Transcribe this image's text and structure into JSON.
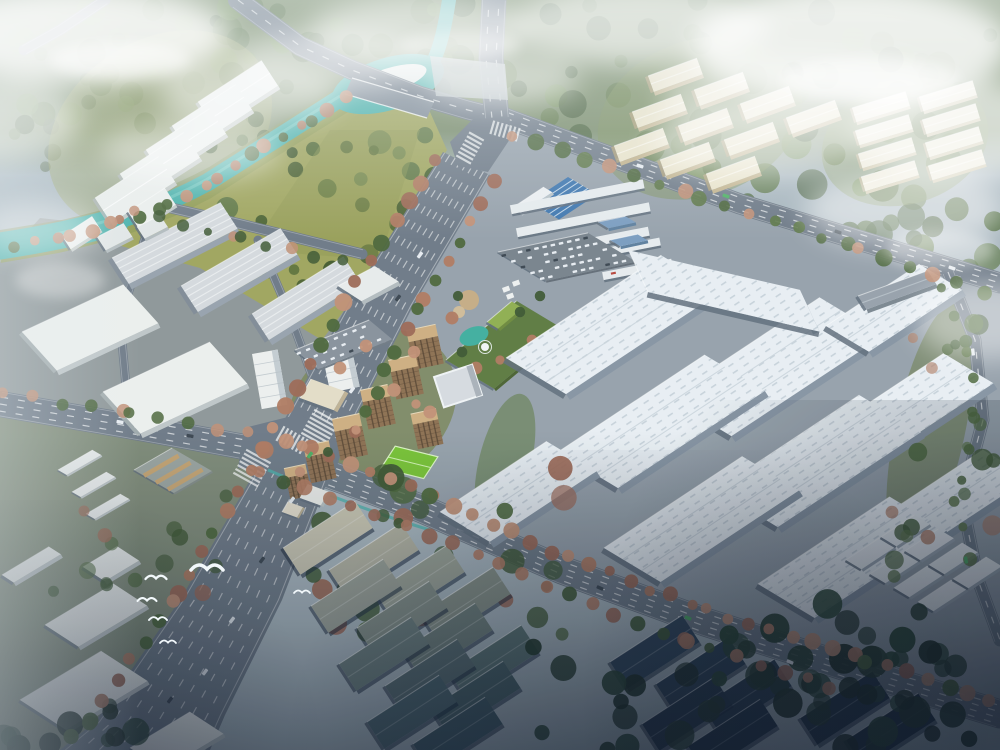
{
  "scene": {
    "description": "Aerial bird's-eye architectural rendering of a planned industrial park campus: large white factory halls in a rotated grid, an entrance gate with blue roof, staff parking, landscaped garden with pond, residential mid-rise towers with a bright green sports field, a public park with a teal canal and bridge, rows of white and cream warehouses, tree-lined avenues, flying gulls, morning haze and clouds, dark shadowed warehouse district at the bottom",
    "style": "photorealistic 3D masterplan rendering, hazy daylight, no visible text",
    "regions": [
      "park-with-canal",
      "factory-campus",
      "residential-cluster",
      "west-industrial-area",
      "northwest-warehouses",
      "upper-right-cream-clusters",
      "dark-south-warehouses",
      "main-avenue",
      "cross-avenue",
      "north-road"
    ]
  },
  "counts": {
    "factory_halls": 11,
    "northwest_warehouses": 5,
    "cream_buildings": 18,
    "residential_towers": 7,
    "dark_warehouses": 20,
    "birds": 6
  },
  "palette": {
    "base": "#a9b7bf",
    "forest_band": "#6a7f53",
    "tree_green1": "#4a6538",
    "tree_green2": "#3c5630",
    "tree_green3": "#5a7443",
    "forest_pale": "#6d8a52",
    "autumn1": "#b0795f",
    "autumn2": "#c28f74",
    "autumn3": "#9c6753",
    "park_grass": "#a0a55c",
    "park_grass2": "#8e9a52",
    "river": "#48b1ab",
    "river_light": "#7fd2ca",
    "island": "#eef1ef",
    "road": "#6d7986",
    "road_light": "#7e8a96",
    "road_dark": "#5b6773",
    "lane_mark": "#ffffff",
    "ground_campus": "#96a1ab",
    "ground_sw": "#7e8a77",
    "ground_industrial": "#8e9698",
    "roof_white": "#eaf0f5",
    "roof_shade": "#c6d0d9",
    "facade": "#8694a3",
    "facade_dark": "#5f6c7a",
    "ribbed_roof": "#d6dbdf",
    "box_white": "#eef1ef",
    "cream_roof": "#ede5cb",
    "cream_shade": "#c2b38c",
    "cream_light": "#f2ecda",
    "blue_gate": "#3c74ae",
    "blue_shed": "#7a9cc0",
    "garden_green": "#5c7a3f",
    "pond": "#3fae9f",
    "field_green": "#77c433",
    "field_line": "#e8ffd0",
    "resi_roof": "#cfae80",
    "resi_facade": "#8d6f50",
    "resi_window": "#54422f",
    "office_grey": "#d7dce1",
    "tan_canopy": "#c8a46f",
    "dark_tree": "#1e3424",
    "car_white": "#e9eef3",
    "car_dark": "#39444f",
    "bus_green": "#4cae62",
    "bird": "#f2f8fb",
    "cloud": "#ffffff"
  }
}
